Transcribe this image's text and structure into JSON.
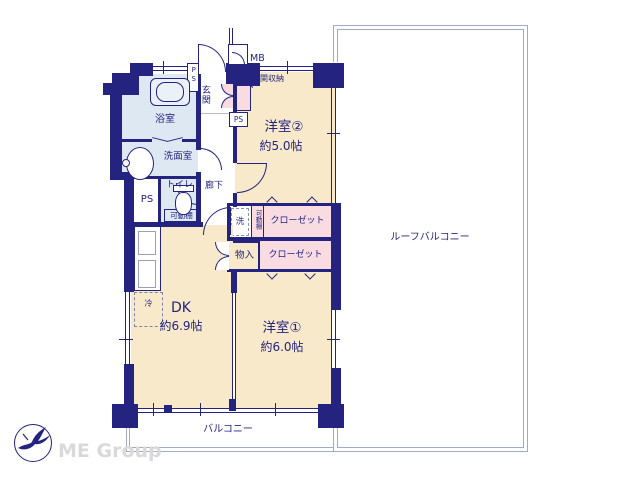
{
  "plan_type": "apartment-floor-plan",
  "labels": {
    "room2_name": "洋室②",
    "room2_size": "約5.0帖",
    "room1_name": "洋室①",
    "room1_size": "約6.0帖",
    "dk_name": "DK",
    "dk_size": "約6.9帖",
    "bathroom": "浴室",
    "washroom": "洗面室",
    "toilet": "トイレ",
    "entrance": "玄関",
    "entrance_storage": "玄関収納",
    "corridor": "廊下",
    "ps_left": "PS",
    "ps_top": "PS",
    "ps_corner": "PS",
    "mb": "MB",
    "washer": "洗",
    "movable_shelf_toilet": "可動棚",
    "movable_shelf_closet": "可動棚",
    "closet_room2": "クローゼット",
    "closet_room1": "クローゼット",
    "storage": "物入",
    "fridge": "冷",
    "balcony": "バルコニー",
    "roof_balcony": "ルーフバルコニー"
  },
  "branding": {
    "company": "ME Group"
  },
  "colors": {
    "wall": "#242480",
    "label": "#242480",
    "room_cream": "#f7e9c9",
    "wet_blue": "#dde8f3",
    "closet_pink": "#f8dce2",
    "balcony_line": "#a3a9c9",
    "watermark": "#d9d9d9"
  }
}
